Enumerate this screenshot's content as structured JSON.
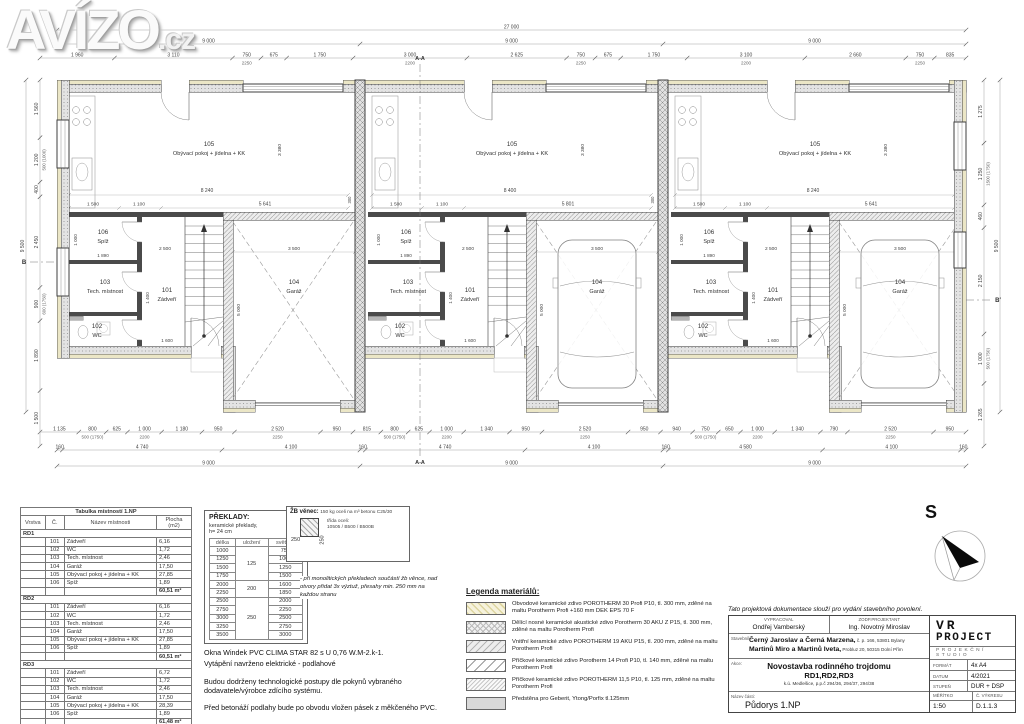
{
  "watermark": {
    "text": "AVÍZO",
    "suffix": ".cz"
  },
  "plan": {
    "overall_top": "27 000",
    "unit_span": "9 000",
    "top_detail": [
      "1 960",
      "3 110",
      "750/2250",
      "675",
      "1 750",
      "3 000/2200",
      "2 625",
      "750/2250",
      "675",
      "1 750",
      "3 100/2200",
      "2 660",
      "750/2250",
      "835"
    ],
    "bottom_detail": [
      "1 135",
      "800/500 (1750)",
      "625",
      "1 000/2200",
      "1 180",
      "950",
      "2 520/2250",
      "950",
      "815",
      "800/500 (1750)",
      "625",
      "1 000/2200",
      "1 340",
      "950",
      "2 520/2250",
      "950",
      "940",
      "750/500 (1750)",
      "650",
      "1 000/2200",
      "1 340",
      "790",
      "2 520/2250",
      "950"
    ],
    "bottom_mid": [
      "160",
      "4 740",
      "4 100",
      "160",
      "4 740",
      "4 100",
      "160",
      "4 580",
      "4 100",
      "160"
    ],
    "bottom_units": [
      "9 000",
      "9 000",
      "9 000"
    ],
    "left_chain": [
      "1 560",
      "1 200/500 (1000)",
      "400",
      "2 450",
      "900/600 (1750)",
      "1 890",
      "1 500"
    ],
    "left_overall": "9 500",
    "right_chain": [
      "1 275",
      "1 250/1500 (1750)",
      "460",
      "2 150",
      "1 000/500 (1750)",
      "1 265"
    ],
    "right_overall": "9 500",
    "section_a": "A",
    "section_b": "B",
    "rooms": [
      {
        "num": "101",
        "name": "Zádveří"
      },
      {
        "num": "102",
        "name": "WC"
      },
      {
        "num": "103",
        "name": "Tech. místnost"
      },
      {
        "num": "104",
        "name": "Garáž"
      },
      {
        "num": "105",
        "name": "Obývací pokoj + jídelna + KK"
      },
      {
        "num": "106",
        "name": "Spíž"
      }
    ],
    "units": [
      {
        "id": "RD1",
        "dim_w1": "8 240",
        "dim_w2": "5 641",
        "car": false
      },
      {
        "id": "RD2",
        "dim_w1": "8 400",
        "dim_w2": "5 801",
        "car": true
      },
      {
        "id": "RD3",
        "dim_w1": "8 240",
        "dim_w2": "5 641",
        "car": true
      }
    ],
    "inner_dims": {
      "liv_a": "1 500",
      "liv_b": "1 100",
      "liv_h": "3 380",
      "spiz_h": "1 000",
      "spiz_w": "1 890",
      "zadv_w": "2 500",
      "gar_w": "3 500",
      "gar_h": "5 000",
      "zadv_h": "1 400",
      "door_w": "1 600",
      "edge": "300"
    }
  },
  "room_table": {
    "title": "Tabulka místností 1.NP",
    "columns": [
      "Vrstva",
      "Č.",
      "Název místnosti",
      "Plocha (m2)"
    ],
    "groups": [
      {
        "label": "RD1",
        "rows": [
          [
            "101",
            "Zádveří",
            "6,16"
          ],
          [
            "102",
            "WC",
            "1,72"
          ],
          [
            "103",
            "Tech. místnost",
            "2,46"
          ],
          [
            "104",
            "Garáž",
            "17,50"
          ],
          [
            "105",
            "Obývací pokoj + jídelna + KK",
            "27,85"
          ],
          [
            "106",
            "Spíž",
            "1,89"
          ]
        ],
        "subtotal": "60,51 m²"
      },
      {
        "label": "RD2",
        "rows": [
          [
            "101",
            "Zádveří",
            "6,16"
          ],
          [
            "102",
            "WC",
            "1,72"
          ],
          [
            "103",
            "Tech. místnost",
            "2,46"
          ],
          [
            "104",
            "Garáž",
            "17,50"
          ],
          [
            "105",
            "Obývací pokoj + jídelna + KK",
            "27,85"
          ],
          [
            "106",
            "Spíž",
            "1,89"
          ]
        ],
        "subtotal": "60,51 m²"
      },
      {
        "label": "RD3",
        "rows": [
          [
            "101",
            "Zádveří",
            "6,72"
          ],
          [
            "102",
            "WC",
            "1,72"
          ],
          [
            "103",
            "Tech. místnost",
            "2,46"
          ],
          [
            "104",
            "Garáž",
            "17,50"
          ],
          [
            "105",
            "Obývací pokoj + jídelna + KK",
            "28,39"
          ],
          [
            "106",
            "Spíž",
            "1,89"
          ]
        ],
        "subtotal": "61,48 m²"
      }
    ],
    "total": "182,50 m²"
  },
  "lintels": {
    "title": "PŘEKLADY:",
    "subtitle": "keramické překlady,\nh= 24 cm",
    "columns": [
      "délka",
      "uložení",
      "světlost"
    ],
    "groups": [
      {
        "ulozeni": "125",
        "rows": [
          [
            "1000",
            "750"
          ],
          [
            "1250",
            "1000"
          ],
          [
            "1500",
            "1250"
          ],
          [
            "1750",
            "1500"
          ]
        ]
      },
      {
        "ulozeni": "200",
        "rows": [
          [
            "2000",
            "1600"
          ],
          [
            "2250",
            "1850"
          ]
        ]
      },
      {
        "ulozeni": "250",
        "rows": [
          [
            "2500",
            "2000"
          ],
          [
            "2750",
            "2250"
          ],
          [
            "3000",
            "2500"
          ],
          [
            "3250",
            "2750"
          ],
          [
            "3500",
            "3000"
          ]
        ]
      }
    ]
  },
  "venec": {
    "title": "ŽB věnec:",
    "spec": "150 kg oceli na m³ betonu C25/30",
    "dim_a": "250",
    "dim_b": "250",
    "steel": "třída oceli:",
    "steel2": "10505 / B500 / B500B",
    "note": "- při monolitických překladech součástí žb věnce, nad otvory přidat 3x výztuž, přesahy min. 250 mm na každou stranu"
  },
  "notes": {
    "line1": "Okna Windek PVC CLIMA STAR 82 s U 0,76 W.M-2.k-1.",
    "line2": "Vytápění navrženo elektrické - podlahové",
    "line3": "Budou dodrženy technologické postupy dle pokynů vybraného dodavatele/výrobce zdícího systému.",
    "line4": "Před betonáží podlahy bude po obvodu vložen pásek z měkčeného PVC."
  },
  "legend": {
    "title": "Legenda materiálů:",
    "items": [
      {
        "swatch": "porotherm-30-profi",
        "text": "Obvodové keramické zdivo POROTHERM 30 Profi P10, tl. 300 mm, zděné na maltu Porotherm Profi +160 mm DEK EPS 70 F"
      },
      {
        "swatch": "porotherm-30-aku-z",
        "text": "Dělící nosné keramické akustické zdivo Porotherm 30 AKU Z P15, tl. 300 mm, zděné na maltu Porotherm Profi"
      },
      {
        "swatch": "porotherm-19-aku",
        "text": "Vnitřní keramické zdivo POROTHERM 19 AKU P15, tl. 200 mm, zděné na maltu Porotherm Profi"
      },
      {
        "swatch": "porotherm-14-profi",
        "text": "Příčkové keramické zdivo Porotherm 14 Profi P10, tl. 140 mm, zděné na maltu Porotherm Profi"
      },
      {
        "swatch": "porotherm-11-5",
        "text": "Příčkové keramické zdivo POROTHERM 11,5 P10, tl. 125 mm, zděné na maltu Porotherm Profi"
      },
      {
        "swatch": "predstena",
        "text": "Předstěna pro Geberit, Ytong/Porfix tl.125mm"
      }
    ]
  },
  "title_block": {
    "disclaimer": "Tato projektová dokumentace slouží pro vydání stavebního povolení.",
    "vypracoval_label": "VYPRACOVAL",
    "vypracoval": "Ondřej Vamberský",
    "zodp_label": "ZODP.PROJEKTANT",
    "zodp": "Ing. Novotný Miroslav",
    "stavebnik_label": "Stavebník:",
    "stavebnik1": "Černý Jaroslav a Černá Marzena,",
    "stavebnik1b": " č. p. 166, 53801 Bylany",
    "stavebnik2": "Martinů Miro a Martinů Iveta,",
    "stavebnik2b": " Probluz 20, 50315 Dolní Přím",
    "akce_label": "Akce:",
    "akce1": "Novostavba rodinného trojdomu",
    "akce2": "RD1,RD2,RD3",
    "akce3": "k.ú. Medlešice, p.p.č 294/36, 294/37, 294/38",
    "nazev_label": "Název části:",
    "nazev": "Půdorys 1.NP",
    "logo1": "VR",
    "logo2": "PROJECT",
    "logo3": "PROJEKČNÍ",
    "logo4": "STUDIO",
    "format_label": "FORMÁT",
    "format": "4x A4",
    "datum_label": "DATUM",
    "datum": "4/2021",
    "stupen_label": "STUPEŇ",
    "stupen": "DUR + DSP",
    "meritko_label": "MĚŘÍTKO",
    "meritko": "1:50",
    "cislo_label": "Č. VÝKRESU",
    "cislo": "D.1.1.3"
  },
  "compass": {
    "label": "S"
  }
}
